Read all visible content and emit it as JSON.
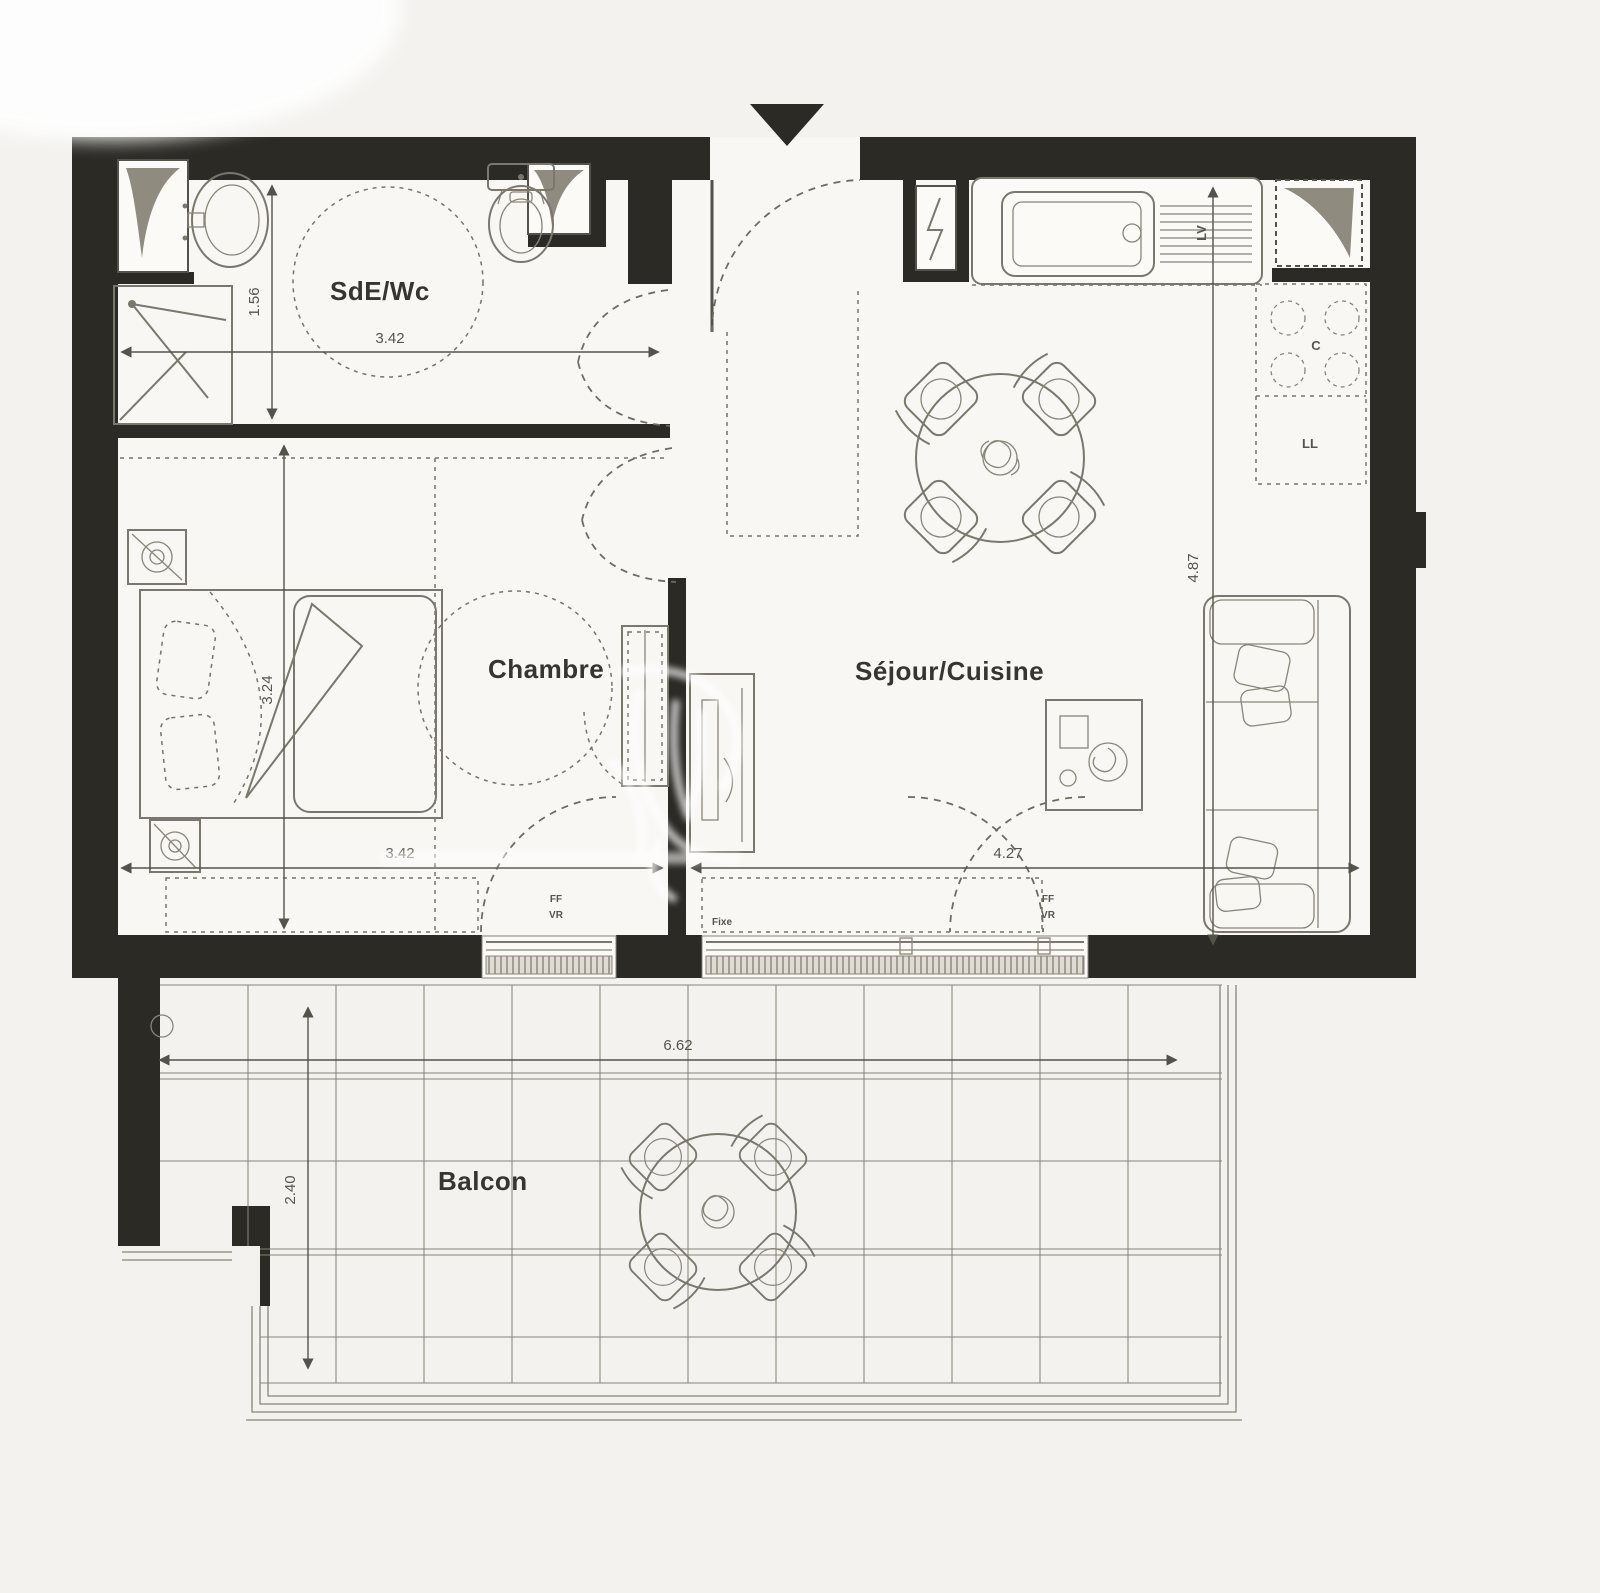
{
  "rooms": {
    "bathroom": "SdE/Wc",
    "bedroom": "Chambre",
    "living": "Séjour/Cuisine",
    "balcony": "Balcon"
  },
  "dimensions": {
    "bathroom_width": "3.42",
    "bathroom_depth": "1.56",
    "bedroom_depth": "3.24",
    "bedroom_width": "3.42",
    "living_width": "4.27",
    "living_depth": "4.87",
    "balcony_width": "6.62",
    "balcony_depth": "2.40"
  },
  "equipment": {
    "dishwasher": "LV",
    "cooktop": "C",
    "washer": "LL"
  },
  "windows": {
    "fixed": "Fixe",
    "french_window": "FF",
    "rolling_shutter": "VR"
  },
  "colors": {
    "wall": "#2b2a25",
    "pencil": "#7b776d",
    "dimension": "#55524b",
    "paper": "#f3f2ef",
    "shaft_triangle": "#8f8b7f"
  }
}
